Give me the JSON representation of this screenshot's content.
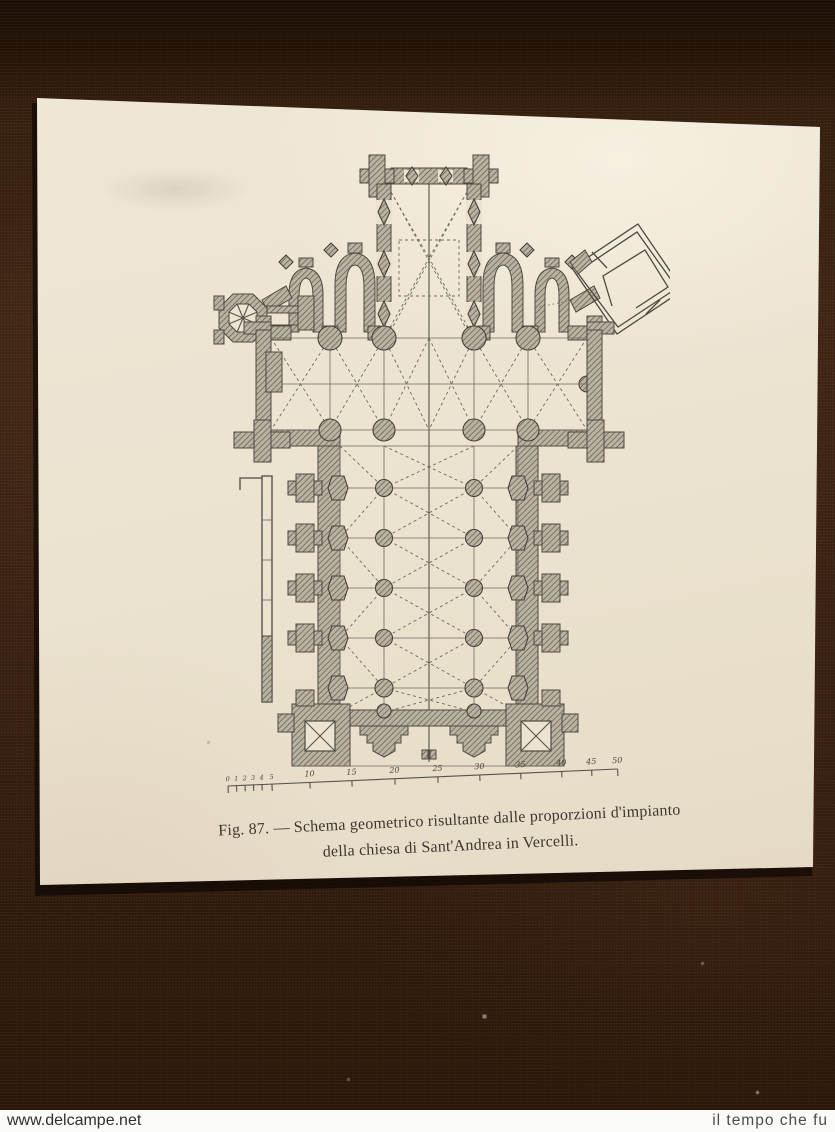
{
  "figure": {
    "caption_line1": "Fig. 87. — Schema geometrico risultante dalle proporzioni d'impianto",
    "caption_line2": "della chiesa di Sant'Andrea in Vercelli.",
    "subject": "Geometric floor plan of the church of Sant'Andrea in Vercelli"
  },
  "scale_bar": {
    "minor_labels": [
      "0",
      "1",
      "2",
      "3",
      "4",
      "5"
    ],
    "major_labels": [
      "10",
      "15",
      "20",
      "25",
      "30",
      "35",
      "40",
      "45",
      "50"
    ]
  },
  "watermarks": {
    "left": "www.delcampe.net",
    "right": "il tempo che fu"
  },
  "colors": {
    "fabric": "#3a2112",
    "paper": "#e9e0cc",
    "ink": "#55504a",
    "wall_hatch": "#8f897b"
  }
}
